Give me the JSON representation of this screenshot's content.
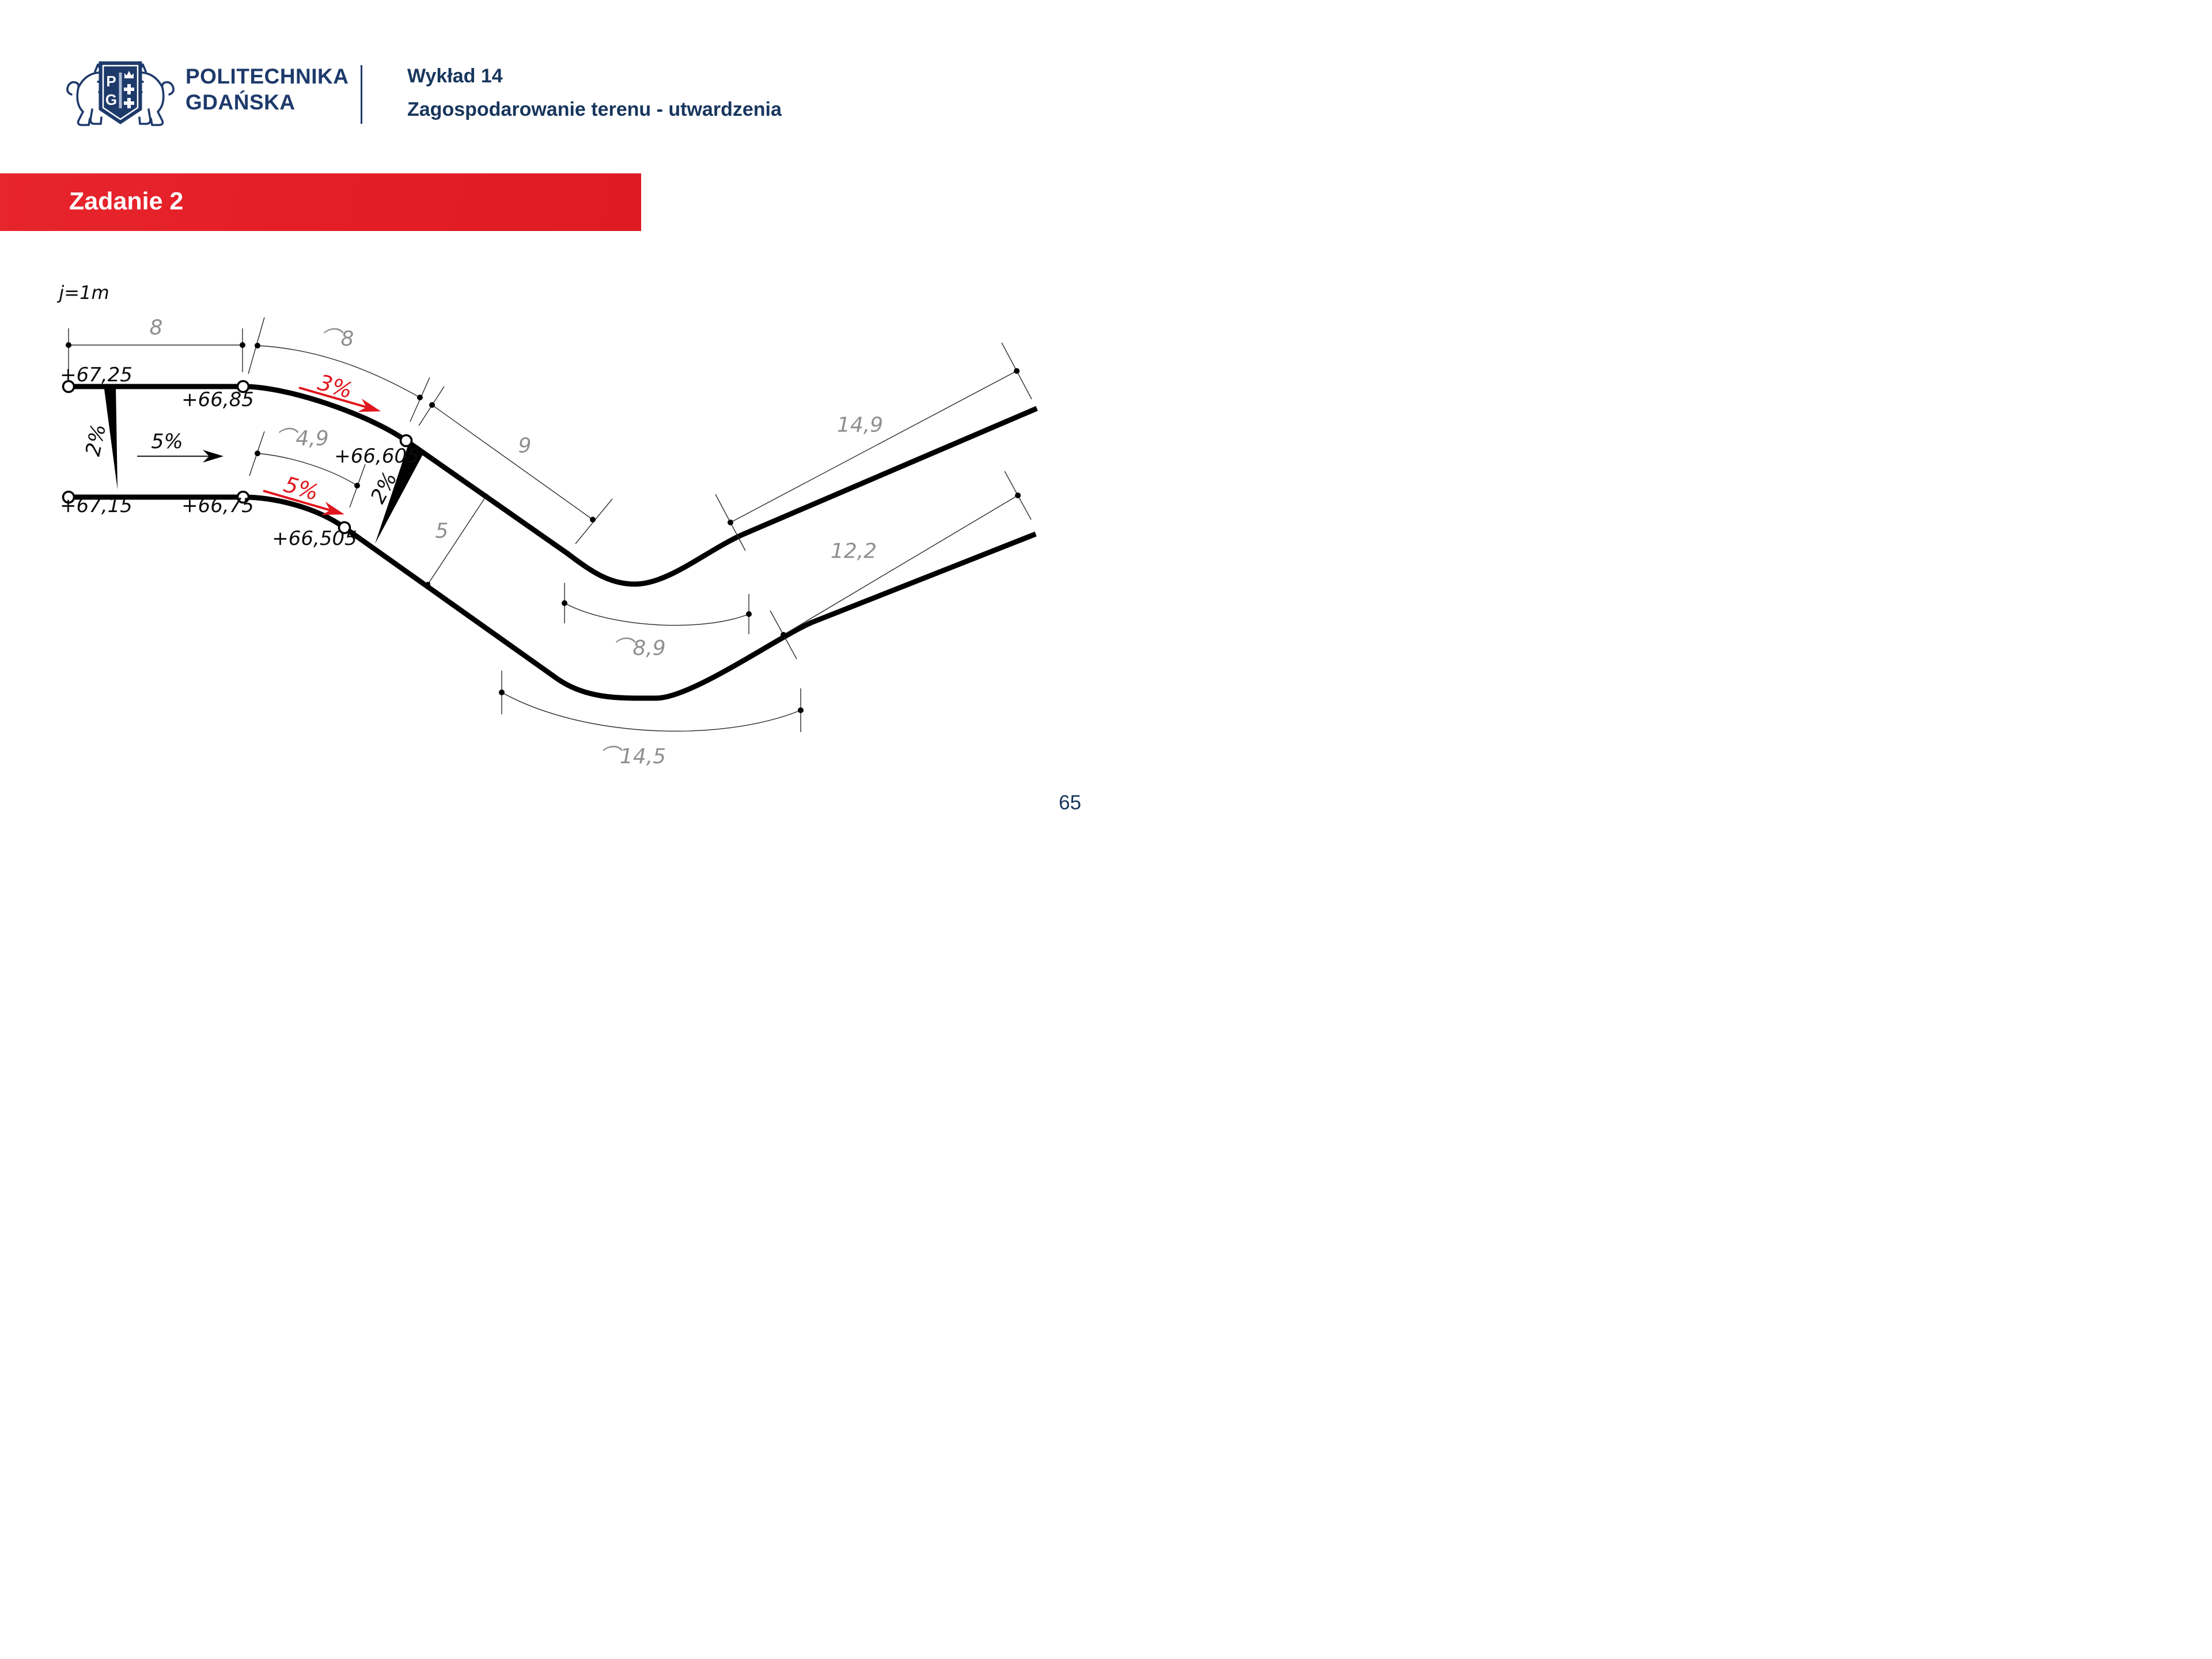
{
  "header": {
    "brand_line1": "POLITECHNIKA",
    "brand_line2": "GDAŃSKA",
    "crest": {
      "shield_letter_p": "P",
      "shield_letter_g": "G"
    },
    "lecture_title": "Wykład 14",
    "lecture_subtitle": "Zagospodarowanie terenu - utwardzenia"
  },
  "banner": {
    "title": "Zadanie 2"
  },
  "colors": {
    "brand_navy": "#1e3a6b",
    "title_navy": "#17365d",
    "banner_red": "#e41e26",
    "annotation_red": "#e0161d",
    "dimension_gray": "#8f8f8f",
    "road_black": "#000000"
  },
  "drawing": {
    "scale_note": "j=1m",
    "elevations": {
      "top_left": "+67,25",
      "top_mid": "+66,85",
      "top_curve": "+66,605",
      "bottom_left": "+67,15",
      "bottom_mid": "+66,75",
      "bottom_curve": "+66,505"
    },
    "slopes": {
      "left_cross": "2%",
      "center_long": "5%",
      "mid_cross": "2%",
      "red_top": "3%",
      "red_bottom": "5%"
    },
    "dimensions": {
      "top_straight": "8",
      "top_arc": "⌒8",
      "diagonal": "9",
      "inner_arc": "⌒4,9",
      "road_width": "5",
      "right_top": "14,9",
      "right_bottom": "12,2",
      "mid_arc": "⌒8,9",
      "bottom_arc": "⌒14,5"
    }
  },
  "page_number": "65"
}
